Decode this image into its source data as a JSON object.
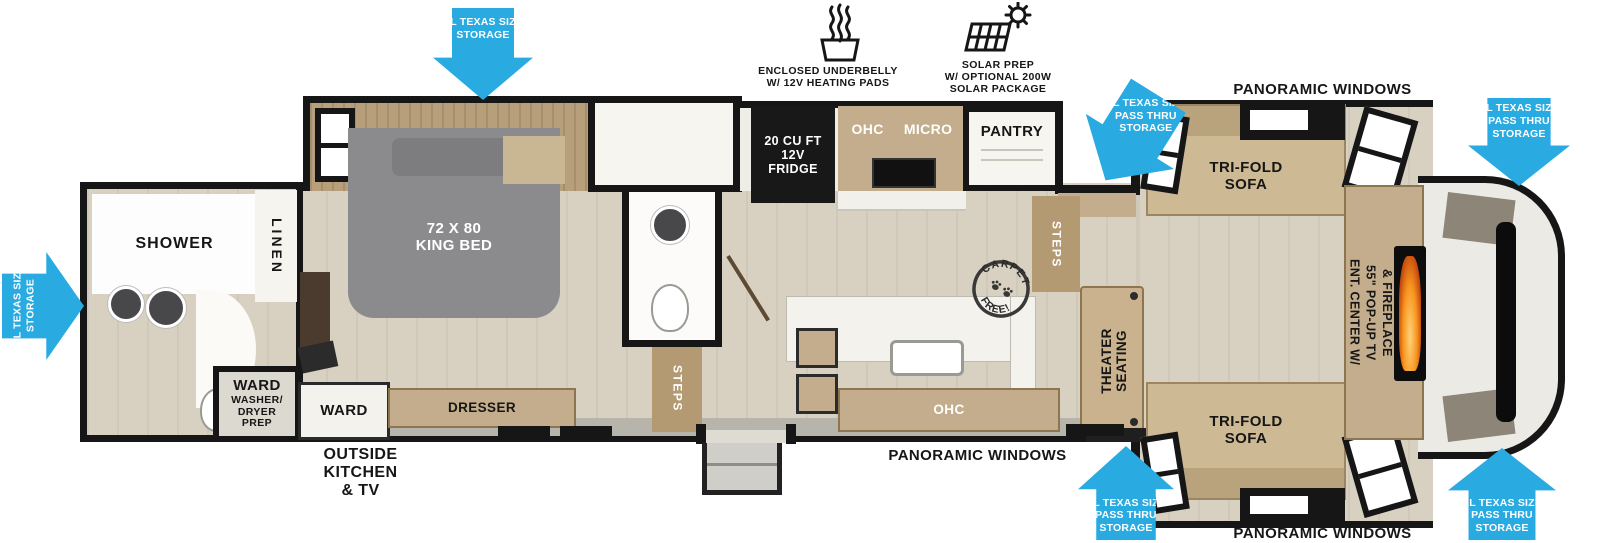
{
  "colors": {
    "arrow_blue": "#29abe2",
    "wall_black": "#161616",
    "wood_tan": "#c3ad8c",
    "floor_tan": "#d8d1c1",
    "fire_orange": "#f7941d"
  },
  "icons": {
    "underbelly1": "ENCLOSED UNDERBELLY",
    "underbelly2": "W/ 12V HEATING PADS",
    "solar1": "SOLAR PREP",
    "solar2": "W/ OPTIONAL 200W",
    "solar3": "SOLAR PACKAGE"
  },
  "callouts": {
    "xl1": "XL TEXAS SIZE",
    "xl2": "STORAGE",
    "pt1": "XL TEXAS SIZE",
    "pt2": "PASS THRU",
    "pt3": "STORAGE"
  },
  "windows": {
    "top": "PANORAMIC WINDOWS",
    "bottom_mid": "PANORAMIC WINDOWS",
    "bottom_right": "PANORAMIC WINDOWS"
  },
  "exterior": {
    "ok1": "OUTSIDE",
    "ok2": "KITCHEN",
    "ok3": "& TV"
  },
  "rooms": {
    "shower": "SHOWER",
    "linen": "LINEN",
    "ward_bath": "WARD",
    "wd1": "WASHER/",
    "wd2": "DRYER",
    "wd3": "PREP",
    "bed1": "72 X 80",
    "bed2": "KING BED",
    "ward_bedroom": "WARD",
    "dresser": "DRESSER",
    "steps_bedroom": "STEPS",
    "steps_living": "STEPS",
    "fridge1": "20 CU FT",
    "fridge2": "12V",
    "fridge3": "FRIDGE",
    "ohc_top": "OHC",
    "micro": "MICRO",
    "pantry": "PANTRY",
    "ohc_island": "OHC",
    "theater1": "THEATER",
    "theater2": "SEATING",
    "sofa_top1": "TRI-FOLD",
    "sofa_top2": "SOFA",
    "sofa_bottom1": "TRI-FOLD",
    "sofa_bottom2": "SOFA",
    "ent1": "ENT. CENTER W/",
    "ent2": "55\" POP-UP TV",
    "ent3": "& FIREPLACE",
    "carpet_top": "CARPET",
    "carpet_bottom": "FREE!"
  }
}
